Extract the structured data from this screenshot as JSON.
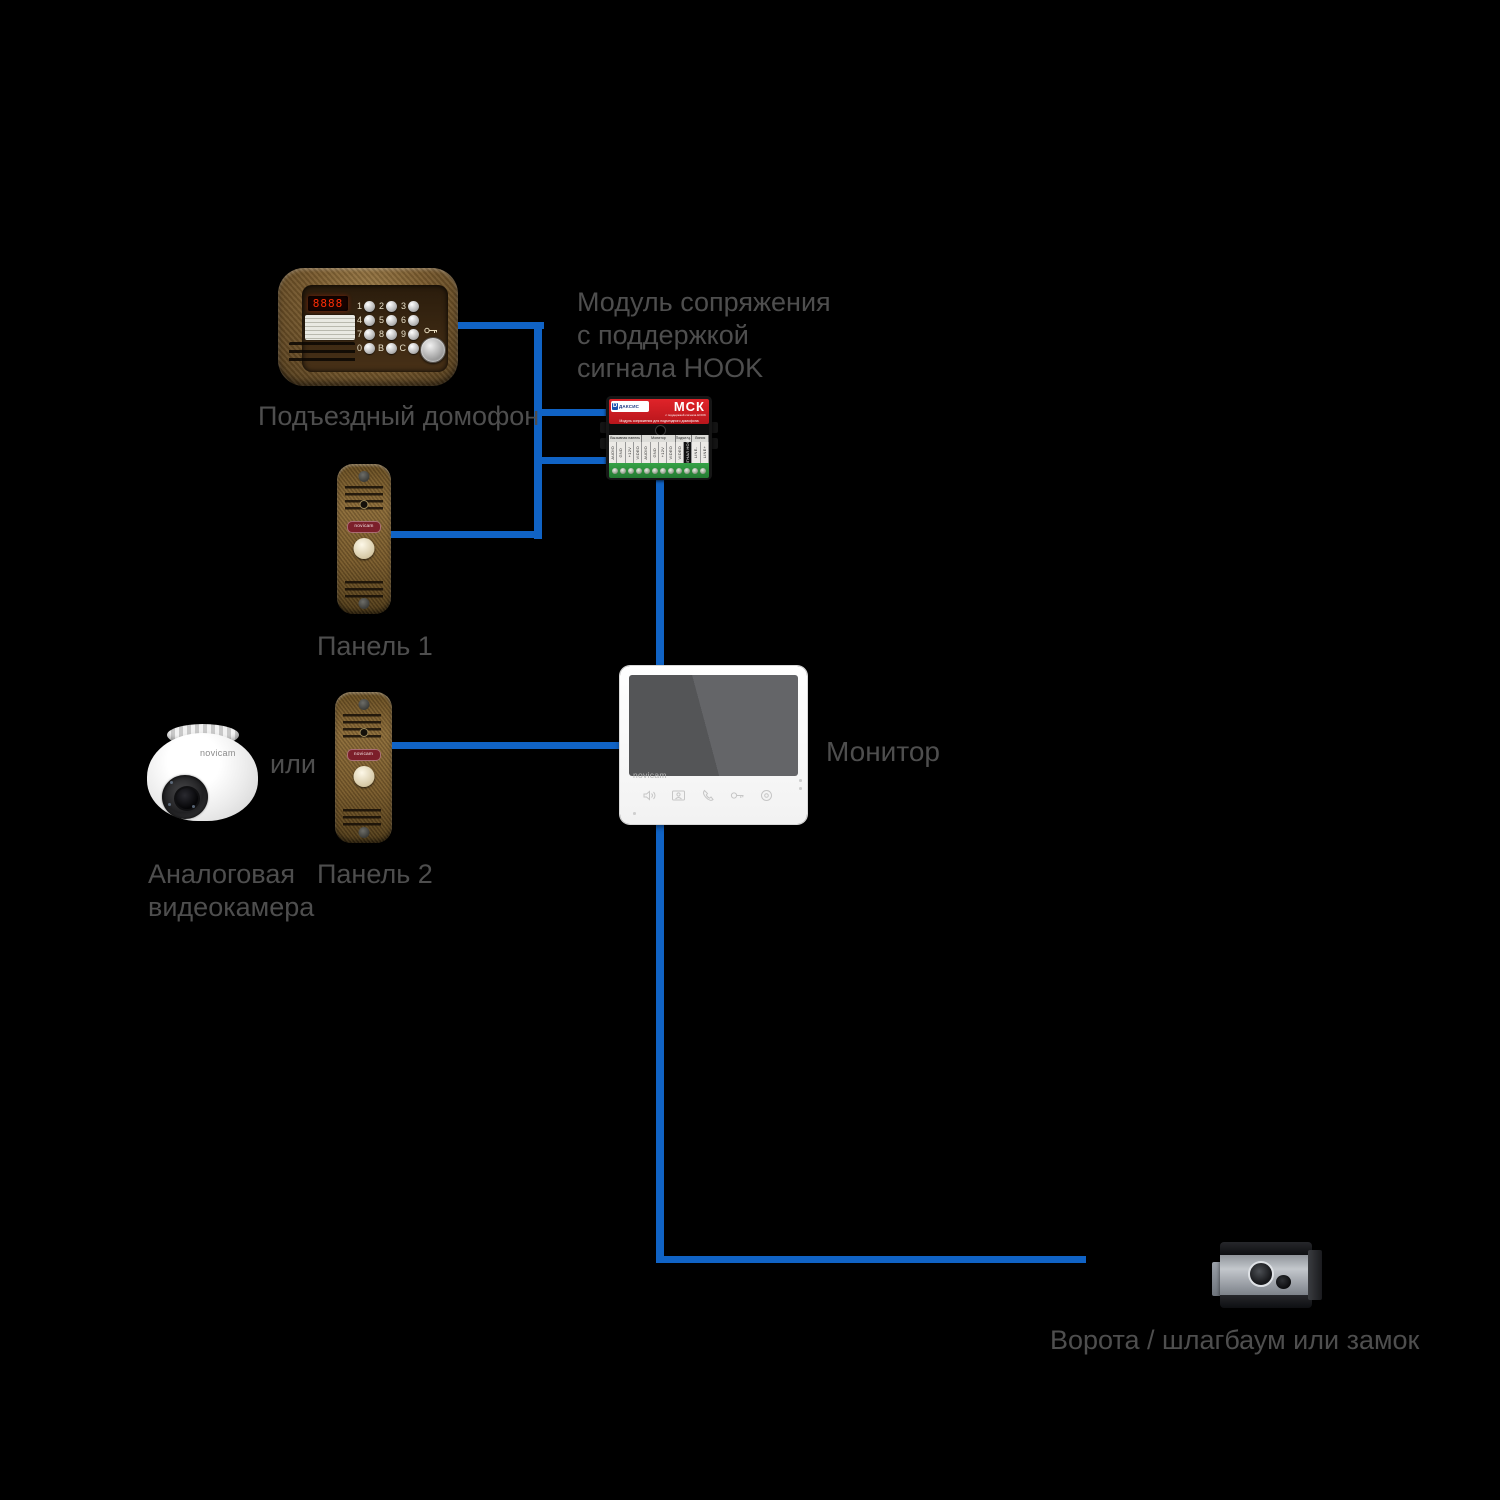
{
  "colors": {
    "background": "#000000",
    "wire_blue": "#1063c5",
    "label_gray": "#4e4e4e",
    "module_red": "#d0191f"
  },
  "labels": {
    "entrance_intercom": "Подъездный домофон",
    "module_note_line1": "Модуль сопряжения",
    "module_note_line2": "с поддержкой",
    "module_note_line3": "сигнала HOOK",
    "panel1": "Панель 1",
    "or": "или",
    "analog_camera_line1": "Аналоговая",
    "analog_camera_line2": "видеокамера",
    "panel2": "Панель 2",
    "monitor": "Монитор",
    "gate": "Ворота / шлагбаум или замок"
  },
  "devices": {
    "intercom": {
      "led_text": "8888",
      "keypad": [
        [
          "1",
          "2",
          "3"
        ],
        [
          "4",
          "5",
          "6"
        ],
        [
          "7",
          "8",
          "9"
        ],
        [
          "0",
          "В",
          "С"
        ]
      ]
    },
    "mck": {
      "brand": "ДАКСИС",
      "logo_letter": "D",
      "model": "МСК",
      "subtitle": "Модуль сопряжения для подъездного домофона",
      "subtitle2": "с поддержкой сигнала HOOK",
      "groups": [
        {
          "label": "Вызывная панель",
          "span": 4
        },
        {
          "label": "Монитор",
          "span": 4
        },
        {
          "label": "Подъезд. домофон",
          "span": 2
        },
        {
          "label": "Линия",
          "span": 2
        }
      ],
      "terminals": [
        "AUDIO",
        "GND",
        "+12V",
        "VIDEO",
        "AUDIO",
        "GND",
        "+12V",
        "VIDEO",
        "VIDEO",
        "СИГНАЛ HOOK",
        "LINE-",
        "LINE+"
      ],
      "dark_terminal": "СИГНАЛ HOOK"
    },
    "door_panel_brand": "novicam",
    "camera_brand": "novicam",
    "monitor_brand": "novicam"
  }
}
